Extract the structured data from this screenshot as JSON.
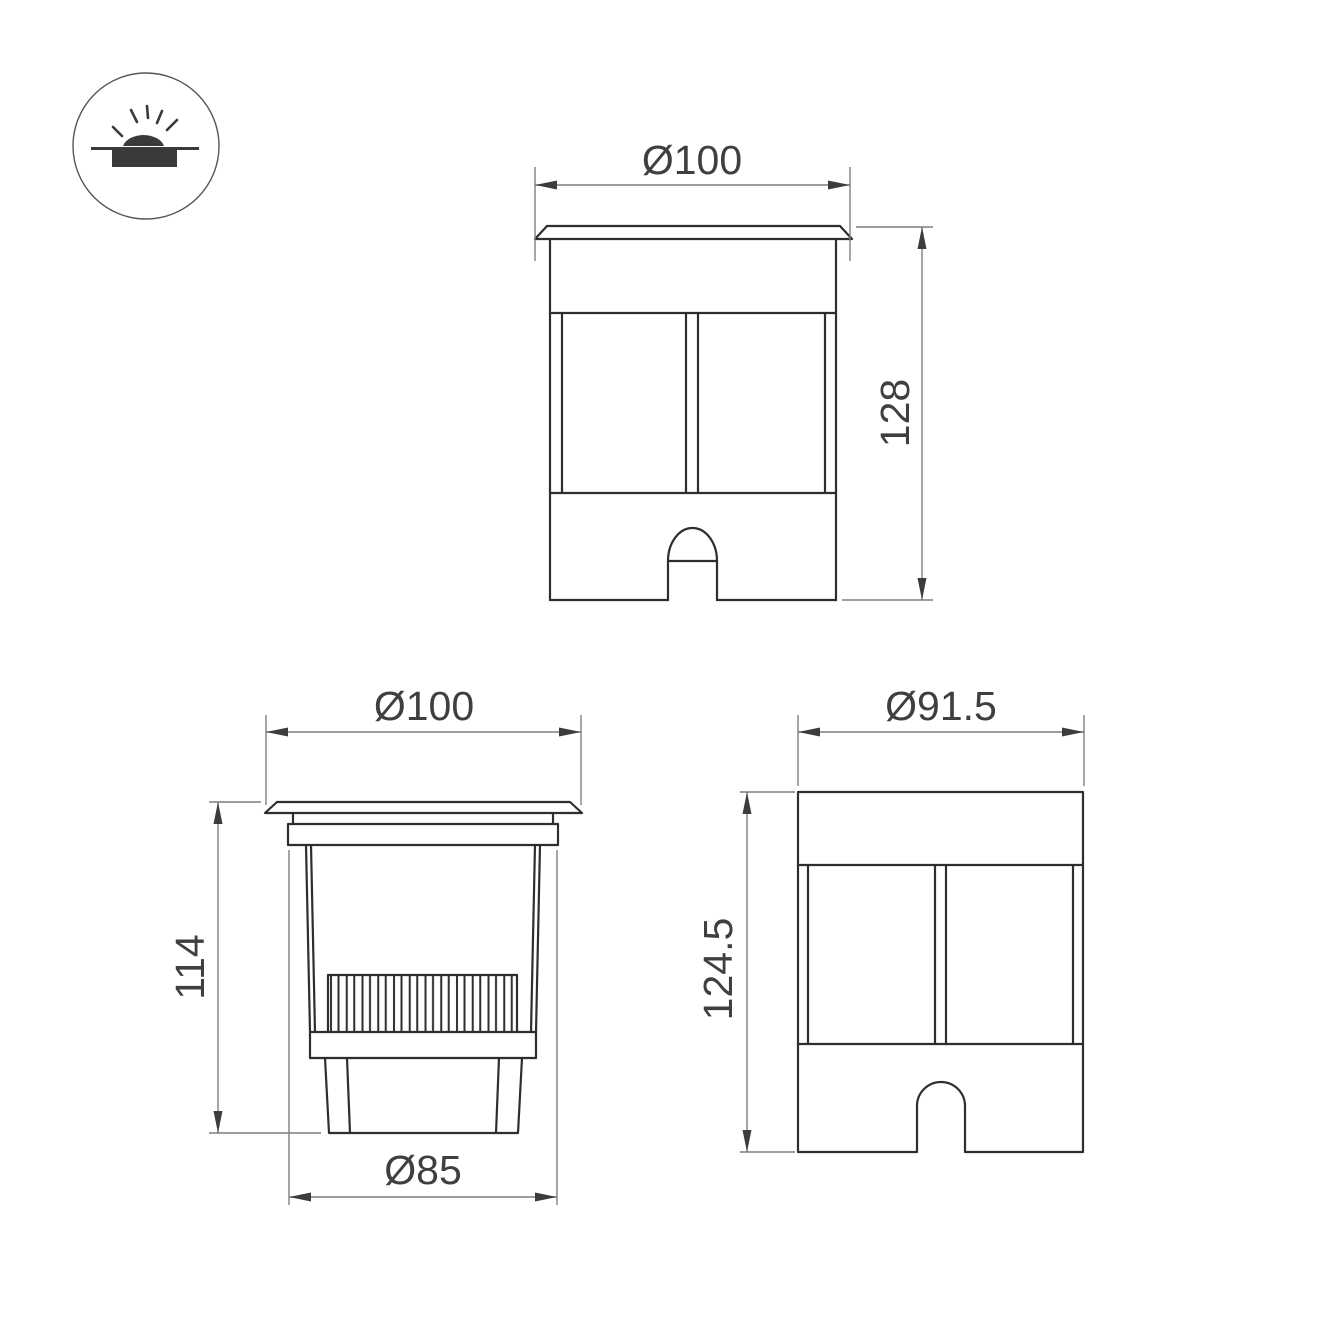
{
  "icon": {
    "name": "recessed-ground-light-icon"
  },
  "views": {
    "front": {
      "diameter_label": "Ø100",
      "height_label": "128"
    },
    "section": {
      "top_diameter_label": "Ø100",
      "height_label": "114",
      "body_diameter_label": "Ø85"
    },
    "side": {
      "diameter_label": "Ø91.5",
      "height_label": "124.5"
    }
  },
  "colors": {
    "background": "#ffffff",
    "outline": "#2e2e2e",
    "dimension_line": "#7f7f7f",
    "arrow": "#3c3c3c",
    "label_text": "#3f3f3f",
    "icon": "#3a3a3a"
  }
}
